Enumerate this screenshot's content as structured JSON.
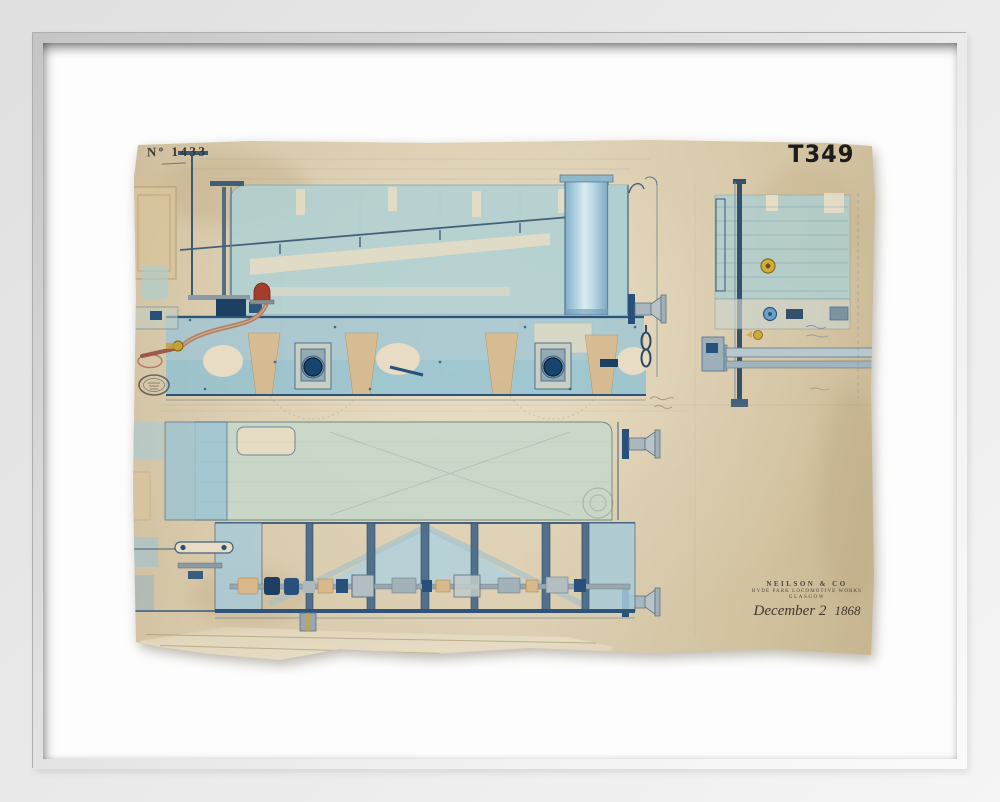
{
  "artwork": {
    "drawing_number": "Nº 1433",
    "catalogue_number": "T349",
    "inscription": {
      "maker": "NEILSON & CO",
      "works": "HYDE PARK LOCOMOTIVE WORKS",
      "city": "GLASGOW",
      "date_script": "December 2",
      "date_year": "1868"
    }
  },
  "palette": {
    "frame_grey": "#cfcfcf",
    "mat_white": "#fdfdfd",
    "paper_tan": "#d6c7a8",
    "wash_teal": "#aed0d2",
    "wash_blue": "#9fc6d4",
    "wash_green": "#c6d8cc",
    "ink_navy": "#1d3f63",
    "ochre_tan": "#d9b88c",
    "copper_pipe": "#b28063",
    "brass_yellow": "#d2ae3f",
    "valve_red": "#a63d2c",
    "metal_grey": "#aab8bd",
    "pencil_grey": "#8b8574"
  }
}
